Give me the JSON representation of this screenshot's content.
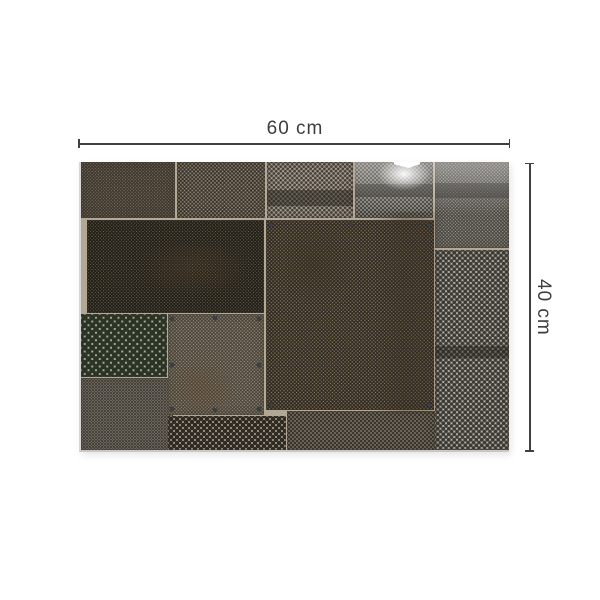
{
  "page": {
    "background": "#ffffff"
  },
  "dimensions": {
    "width_label": "60 cm",
    "height_label": "40 cm",
    "line_color": "#404040",
    "text_color": "#3d3d3d"
  },
  "artwork": {
    "description": "patchwork collage of weathered perforated metal sheets",
    "seam_color": "#b3a895",
    "edge_left_color": "#d9d7d3",
    "edge_bottom_color": "#c9c7c3",
    "rivet_color": "#3a3f49",
    "panels": [
      {
        "name": "panel-top-left",
        "x": 0,
        "y": 0,
        "w": 94,
        "h": 56,
        "base": "#8f8577",
        "dot": "#3f382e",
        "r": 1.0,
        "g": 3.2
      },
      {
        "name": "panel-top-mid",
        "x": 96,
        "y": 0,
        "w": 88,
        "h": 56,
        "base": "#a89e8c",
        "dot": "#3a342b",
        "r": 1.1,
        "g": 3.8
      },
      {
        "name": "panel-top-center",
        "x": 186,
        "y": 0,
        "w": 86,
        "h": 56,
        "base": "#aba293",
        "dot": "#45403a",
        "r": 1.2,
        "g": 4.6,
        "band": {
          "top": 28,
          "h": 16,
          "color": "rgba(42,38,32,0.50)"
        }
      },
      {
        "name": "panel-top-right",
        "x": 274,
        "y": 0,
        "w": 78,
        "h": 56,
        "base": "#9f9d95",
        "dot": "#43413b",
        "r": 1.1,
        "g": 4.0,
        "band": {
          "top": 22,
          "h": 13,
          "color": "rgba(38,36,31,0.55)"
        }
      },
      {
        "name": "panel-far-right-top",
        "x": 354,
        "y": 0,
        "w": 74,
        "h": 86,
        "base": "#aaa8a1",
        "dot": "#4a4741",
        "r": 1.0,
        "g": 3.4,
        "band": {
          "top": 21,
          "h": 15,
          "color": "rgba(38,36,31,0.50)"
        }
      },
      {
        "name": "panel-dense-left",
        "x": 6,
        "y": 58,
        "w": 177,
        "h": 93,
        "base": "#8a7f63",
        "dot": "#23201a",
        "r": 1.1,
        "g": 3.3
      },
      {
        "name": "panel-central-large",
        "x": 185,
        "y": 58,
        "w": 168,
        "h": 190,
        "base": "#a08d6e",
        "dot": "#2f2a22",
        "r": 1.1,
        "g": 3.6
      },
      {
        "name": "panel-pegboard",
        "x": 0,
        "y": 152,
        "w": 86,
        "h": 63,
        "base": "#b7b3aa",
        "dot": "#2b3526",
        "r": 2.7,
        "g": 7.5
      },
      {
        "name": "panel-bottom-left",
        "x": 0,
        "y": 216,
        "w": 92,
        "h": 72,
        "base": "#9b9486",
        "dot": "#45413a",
        "r": 0.9,
        "g": 3.0
      },
      {
        "name": "panel-square-rivets",
        "x": 87,
        "y": 152,
        "w": 96,
        "h": 101,
        "base": "#a99f89",
        "dot": "#4a443a",
        "r": 1.0,
        "g": 3.4
      },
      {
        "name": "panel-strip-coarse",
        "x": 87,
        "y": 254,
        "w": 118,
        "h": 34,
        "base": "#998f7f",
        "dot": "#2f2b24",
        "r": 1.9,
        "g": 6.0
      },
      {
        "name": "panel-strip-fine",
        "x": 206,
        "y": 249,
        "w": 148,
        "h": 39,
        "base": "#a39a8b",
        "dot": "#3b362e",
        "r": 1.2,
        "g": 4.0
      },
      {
        "name": "panel-polka-right",
        "x": 354,
        "y": 88,
        "w": 74,
        "h": 200,
        "base": "#bab6ad",
        "dot": "#3c3a34",
        "r": 1.7,
        "g": 5.5,
        "band": {
          "top": 96,
          "h": 12,
          "color": "rgba(40,36,30,0.45)"
        }
      }
    ],
    "overlays": [
      {
        "name": "sheen-top-right",
        "x": 274,
        "y": 0,
        "w": 154,
        "h": 70,
        "background": "linear-gradient(180deg, rgba(255,255,255,0.38), rgba(255,255,255,0) 75%)"
      },
      {
        "name": "glare-spot",
        "x": 294,
        "y": -6,
        "w": 58,
        "h": 36,
        "background": "radial-gradient(ellipse at center, rgba(255,255,255,0.95) 0%, rgba(255,255,255,0) 65%)"
      },
      {
        "name": "vertical-shadow",
        "x": 293,
        "y": 50,
        "w": 68,
        "h": 202,
        "background": "linear-gradient(90deg, rgba(55,45,35,0) 0%, rgba(55,45,35,0.30) 45%, rgba(55,45,35,0.22) 75%, rgba(55,45,35,0) 100%)"
      },
      {
        "name": "central-blotch",
        "x": 192,
        "y": 58,
        "w": 82,
        "h": 86,
        "background": "radial-gradient(ellipse at center, rgba(58,47,33,0.40) 0%, rgba(58,47,33,0) 70%)"
      },
      {
        "name": "left-blotch",
        "x": 55,
        "y": 75,
        "w": 115,
        "h": 60,
        "background": "radial-gradient(ellipse at center, rgba(90,68,44,0.32) 0%, rgba(90,68,44,0) 70%)"
      },
      {
        "name": "stain-bottom-left",
        "x": 85,
        "y": 196,
        "w": 72,
        "h": 60,
        "background": "radial-gradient(ellipse at center, rgba(95,72,48,0.40) 0%, rgba(95,72,48,0) 70%)"
      },
      {
        "name": "edge-notch",
        "x": 313,
        "y": -1,
        "w": 26,
        "h": 7,
        "background": "#ffffff",
        "clip": "polygon(0 0, 100% 0, 100% 45%, 55% 100%, 0 45%)"
      }
    ],
    "rivets": [
      [
        91,
        157
      ],
      [
        134,
        156
      ],
      [
        178,
        157
      ],
      [
        91,
        203
      ],
      [
        178,
        203
      ],
      [
        91,
        247
      ],
      [
        134,
        248
      ],
      [
        178,
        247
      ],
      [
        190,
        63
      ],
      [
        270,
        62
      ],
      [
        348,
        63
      ],
      [
        190,
        243
      ],
      [
        348,
        243
      ]
    ]
  }
}
